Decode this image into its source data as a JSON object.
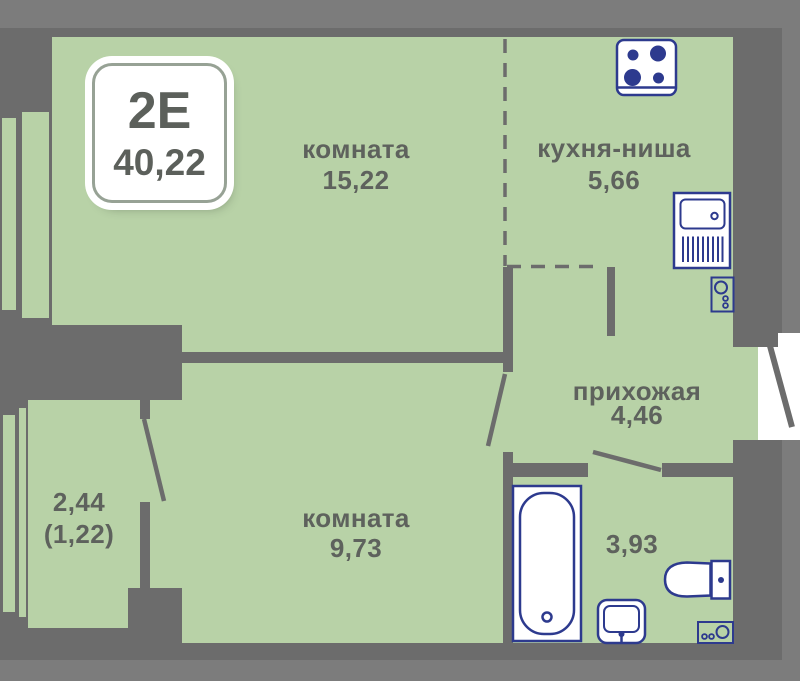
{
  "badge": {
    "type": "2Е",
    "total_area": "40,22"
  },
  "rooms": {
    "living": {
      "name": "комната",
      "area": "15,22"
    },
    "kitchen": {
      "name": "кухня-ниша",
      "area": "5,66"
    },
    "hallway": {
      "name": "прихожая",
      "area": "4,46"
    },
    "bedroom": {
      "name": "комната",
      "area": "9,73"
    },
    "bathroom": {
      "area": "3,93"
    },
    "balcony": {
      "area_full": "2,44",
      "area_reduced": "(1,22)"
    }
  },
  "icons": {
    "kitchen": [
      "stove-icon",
      "kitchen-sink-icon"
    ],
    "hallway": [
      "water-heater-icon"
    ],
    "bathroom": [
      "bathtub-icon",
      "washbasin-icon",
      "toilet-icon",
      "washing-machine-icon"
    ]
  },
  "colors": {
    "background": "#7c7c7c",
    "wall": "#6c6c6c",
    "floor_fill": "#b8d2a7",
    "fixture_outline": "#2d3a8e",
    "label_text": "#5e625d",
    "badge_background": "#ffffff"
  }
}
